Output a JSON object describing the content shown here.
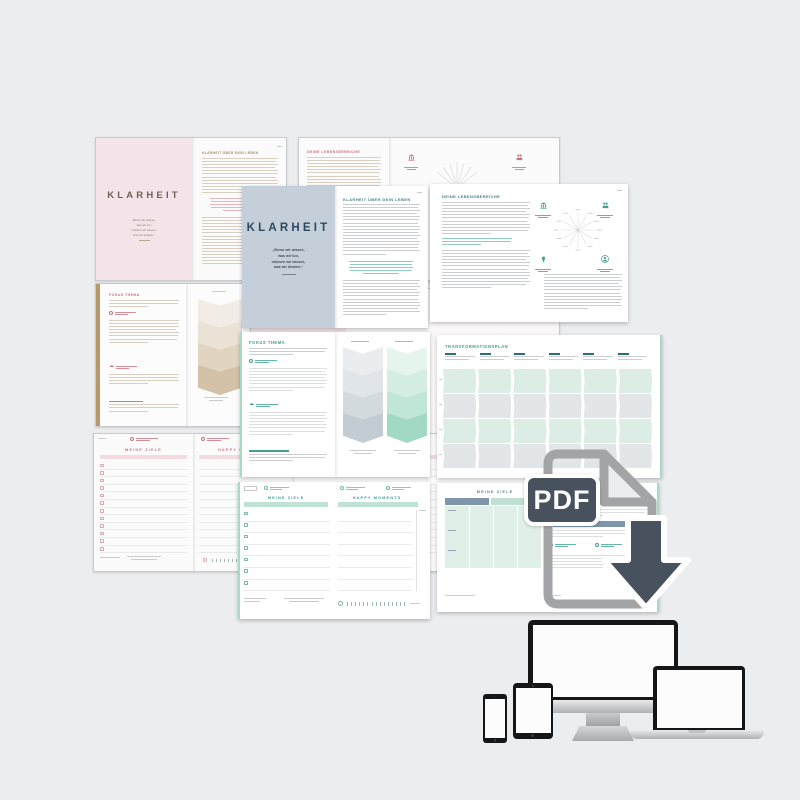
{
  "covers": {
    "title": "KLARHEIT",
    "quote": [
      "„Bevor wir wissen,",
      "was wir tun,",
      "müssen wir wissen,",
      "was wir denken.“"
    ]
  },
  "headings": {
    "klarheit_ueber": "KLARHEIT ÜBER DEIN LEBEN",
    "lebensbereiche": "DEINE LEBENSBEREICHE",
    "fokus": "FOKUS THEMA",
    "transformation": "TRANSFORMATIONSPLAN",
    "ziele": "MEINE ZIELE",
    "happy": "HAPPY MOMENTS"
  },
  "pdf": {
    "label": "PDF"
  },
  "icons": {
    "cloud_glyph": "☁",
    "corner_icons": [
      "institution",
      "community",
      "achievement",
      "self"
    ]
  },
  "chevrons": {
    "beige": [
      "#F1ECE5",
      "#EAE2D5",
      "#E1D5C2",
      "#D4C2A8"
    ],
    "bluegray": [
      "#EAEDEF",
      "#DFE5E8",
      "#D2DADE",
      "#C2CCD2"
    ],
    "mint": [
      "#E6F4EE",
      "#D5EEE3",
      "#BFE6D6",
      "#A2D9C4"
    ]
  },
  "colors": {
    "bg": "#ECEDEF",
    "backpage": "#FBFBFC",
    "pink": "#F4E4EA",
    "pinkband": "#F3DBE1",
    "bluecover": "#C4CFDA",
    "navy": "#2B4961",
    "rose": "#C8747E",
    "tan": "#AE8D64",
    "gold": "#B6996B",
    "teal": "#3FA18E",
    "petrol": "#41808F",
    "mintband": "#BEE3D5",
    "mintedge": "#A8D8C6",
    "cellmint": "#DBEDE5",
    "cellgray": "#E2E6E9",
    "bluehdr": "#7E95AA",
    "slate": "#47525E",
    "filegray": "#A2A4A6",
    "linegray": "#CBCDCF",
    "linebeige": "#D8CFC0",
    "linerose": "#E3B7BD",
    "lineteal": "#8FCDC2",
    "device": "#161616"
  }
}
